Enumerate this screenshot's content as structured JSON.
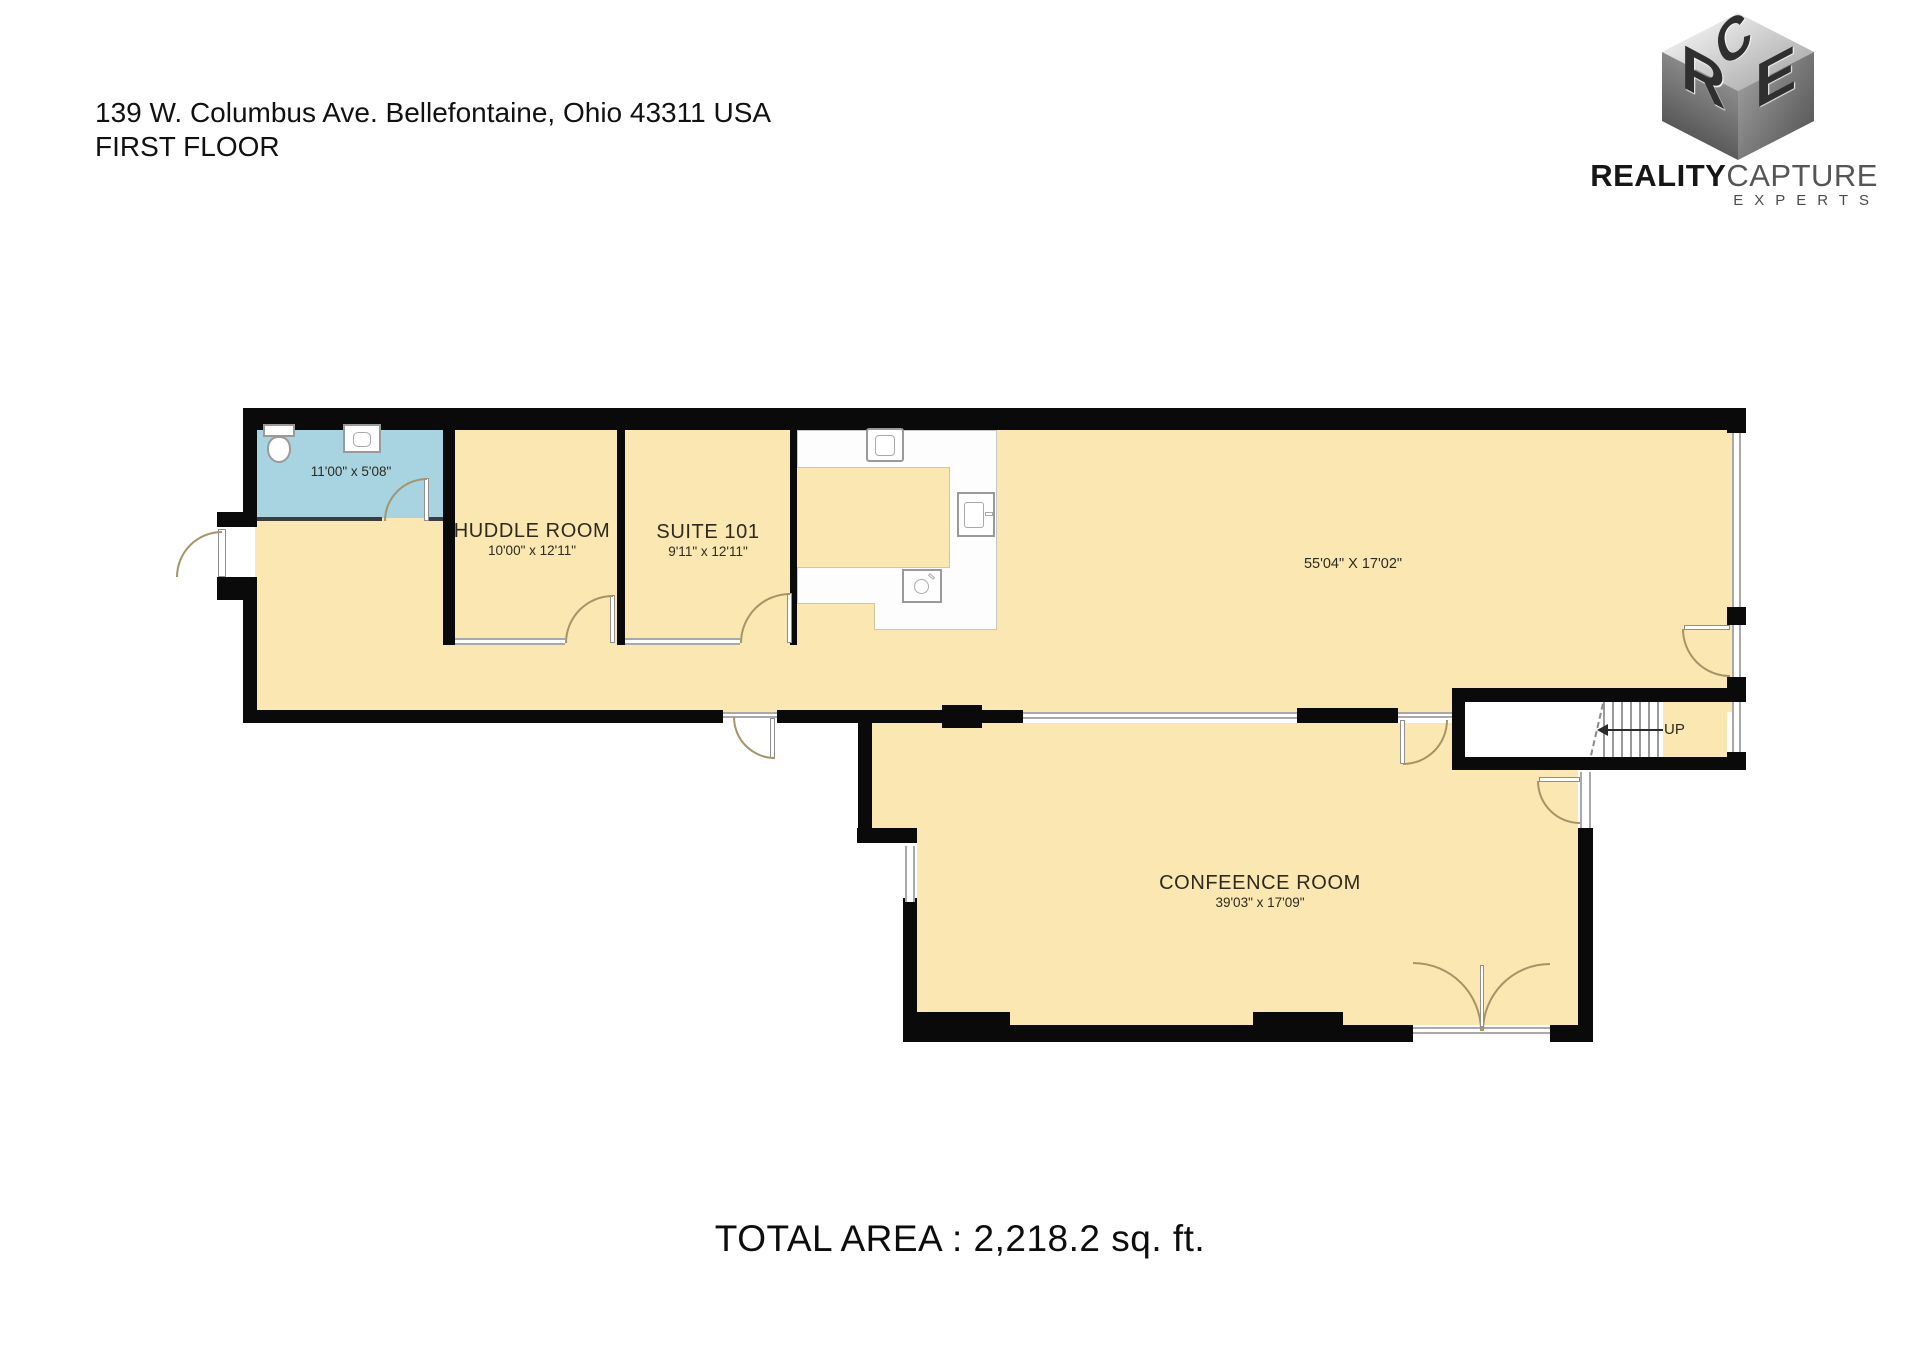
{
  "header": {
    "address": "139 W. Columbus Ave. Bellefontaine, Ohio 43311 USA",
    "floor": "FIRST FLOOR"
  },
  "logo": {
    "cube": {
      "top": "C",
      "left": "R",
      "right": "E"
    },
    "brand_bold": "REALITY",
    "brand_light": "CAPTURE",
    "subtitle": "EXPERTS"
  },
  "rooms": {
    "bathroom": {
      "dims": "11'00\" x 5'08\""
    },
    "huddle": {
      "name": "HUDDLE ROOM",
      "dims": "10'00\" x 12'11\""
    },
    "suite": {
      "name": "SUITE 101",
      "dims": "9'11\" x 12'11\""
    },
    "main": {
      "dims": "55'04\" X 17'02\""
    },
    "conference": {
      "name": "CONFEENCE ROOM",
      "dims": "39'03\" x 17'09\""
    }
  },
  "stairs": {
    "direction_label": "UP"
  },
  "footer": {
    "total_area": "TOTAL AREA : 2,218.2 sq. ft."
  },
  "colors": {
    "floor": "#FAE7B2",
    "bathroom_floor": "#A8D4E2",
    "wall": "#0A0A0A",
    "glass": "#A9A9A9",
    "door_arc": "#A59467"
  }
}
